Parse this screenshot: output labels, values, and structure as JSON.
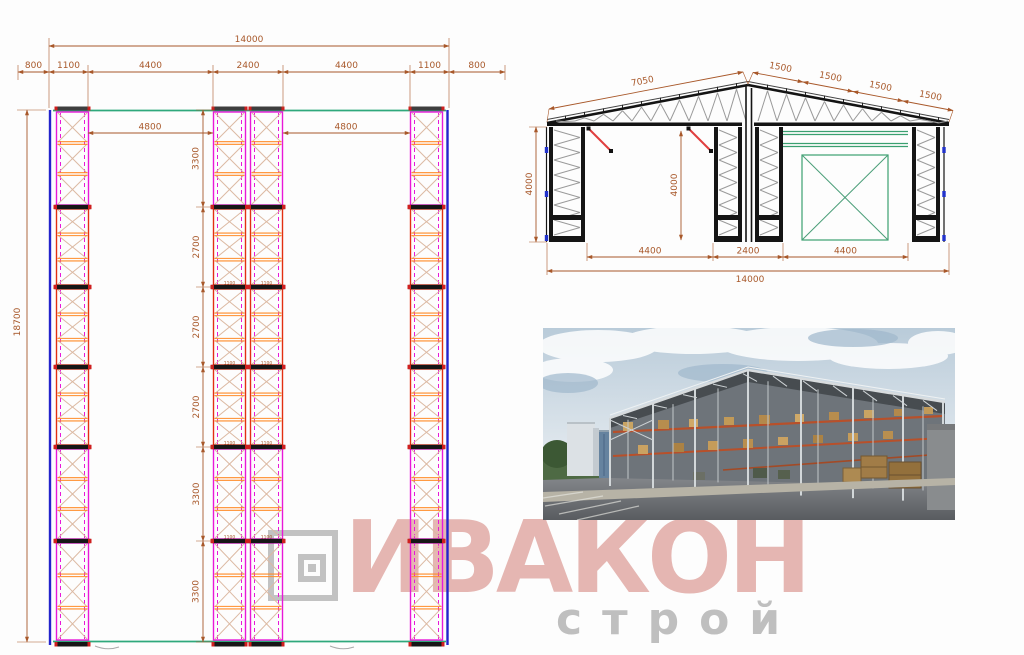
{
  "plan": {
    "dim_total": "14000",
    "dims_top": [
      "800",
      "1100",
      "4400",
      "2400",
      "4400",
      "1100",
      "800"
    ],
    "dim_bay_left": "4800",
    "dim_bay_right": "4800",
    "dim_height": "18700",
    "dims_left": [
      "3300",
      "2700",
      "2700",
      "2700",
      "3300",
      "3300"
    ],
    "joint_label": "1100"
  },
  "elevation": {
    "dim_slope_left": "7050",
    "dims_slope_right": [
      "1500",
      "1500",
      "1500",
      "1500"
    ],
    "dim_height_left": "4000",
    "dim_height_mid": "4000",
    "dims_bottom": [
      "4400",
      "2400",
      "4400"
    ],
    "dim_total": "14000"
  },
  "watermark": {
    "brand": "ИВАКОН",
    "sub": "строй"
  },
  "colors": {
    "dimension": "#a8582a",
    "magenta": "#e818d8",
    "red": "#e22f12",
    "orange": "#ff8c28",
    "green": "#2fa87c",
    "blue": "#2323cc",
    "brand_red": "#c55a52",
    "logo_grey": "#9e9e9e"
  }
}
